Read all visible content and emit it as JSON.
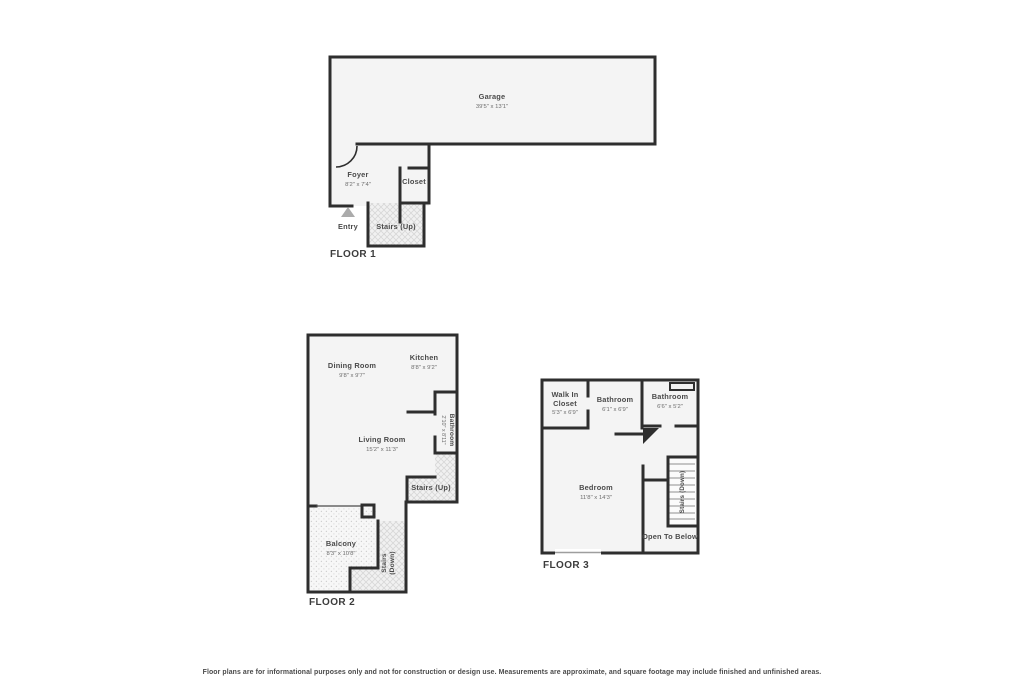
{
  "colors": {
    "wall": "#2e2e2e",
    "room_fill": "#f4f4f4",
    "name_text": "#4a4a4a",
    "dim_text": "#6d6d6d",
    "entry_marker": "#ababab"
  },
  "floor1": {
    "label": "FLOOR 1",
    "garage": {
      "name": "Garage",
      "dims": "39'5\" x 13'1\""
    },
    "foyer": {
      "name": "Foyer",
      "dims": "8'2\" x 7'4\""
    },
    "closet": {
      "name": "Closet"
    },
    "stairs_up": {
      "name": "Stairs (Up)"
    },
    "entry": {
      "name": "Entry"
    }
  },
  "floor2": {
    "label": "FLOOR 2",
    "dining": {
      "name": "Dining Room",
      "dims": "9'8\" x 9'7\""
    },
    "kitchen": {
      "name": "Kitchen",
      "dims": "8'8\" x 9'2\""
    },
    "living": {
      "name": "Living Room",
      "dims": "15'2\" x 11'3\""
    },
    "bathroom": {
      "name": "Bathroom",
      "dims": "2'10\" x 8'11\""
    },
    "stairs_up": {
      "name": "Stairs (Up)"
    },
    "balcony": {
      "name": "Balcony",
      "dims": "8'3\" x 10'8\""
    },
    "stairs_down": {
      "line1": "Stairs",
      "line2": "(Down)"
    }
  },
  "floor3": {
    "label": "FLOOR 3",
    "walk_in_closet": {
      "line1": "Walk In",
      "line2": "Closet",
      "dims": "5'3\" x 6'9\""
    },
    "bathroom1": {
      "name": "Bathroom",
      "dims": "6'1\" x 6'9\""
    },
    "bathroom2": {
      "name": "Bathroom",
      "dims": "6'6\" x 5'2\""
    },
    "bedroom": {
      "name": "Bedroom",
      "dims": "11'8\" x 14'3\""
    },
    "stairs_down": {
      "name": "Stairs (Down)"
    },
    "open_to_below": {
      "name": "Open To Below"
    }
  },
  "footer": {
    "text": "Floor plans are for informational purposes only and not for construction or design use. Measurements are approximate, and square footage may include finished and unfinished areas."
  }
}
